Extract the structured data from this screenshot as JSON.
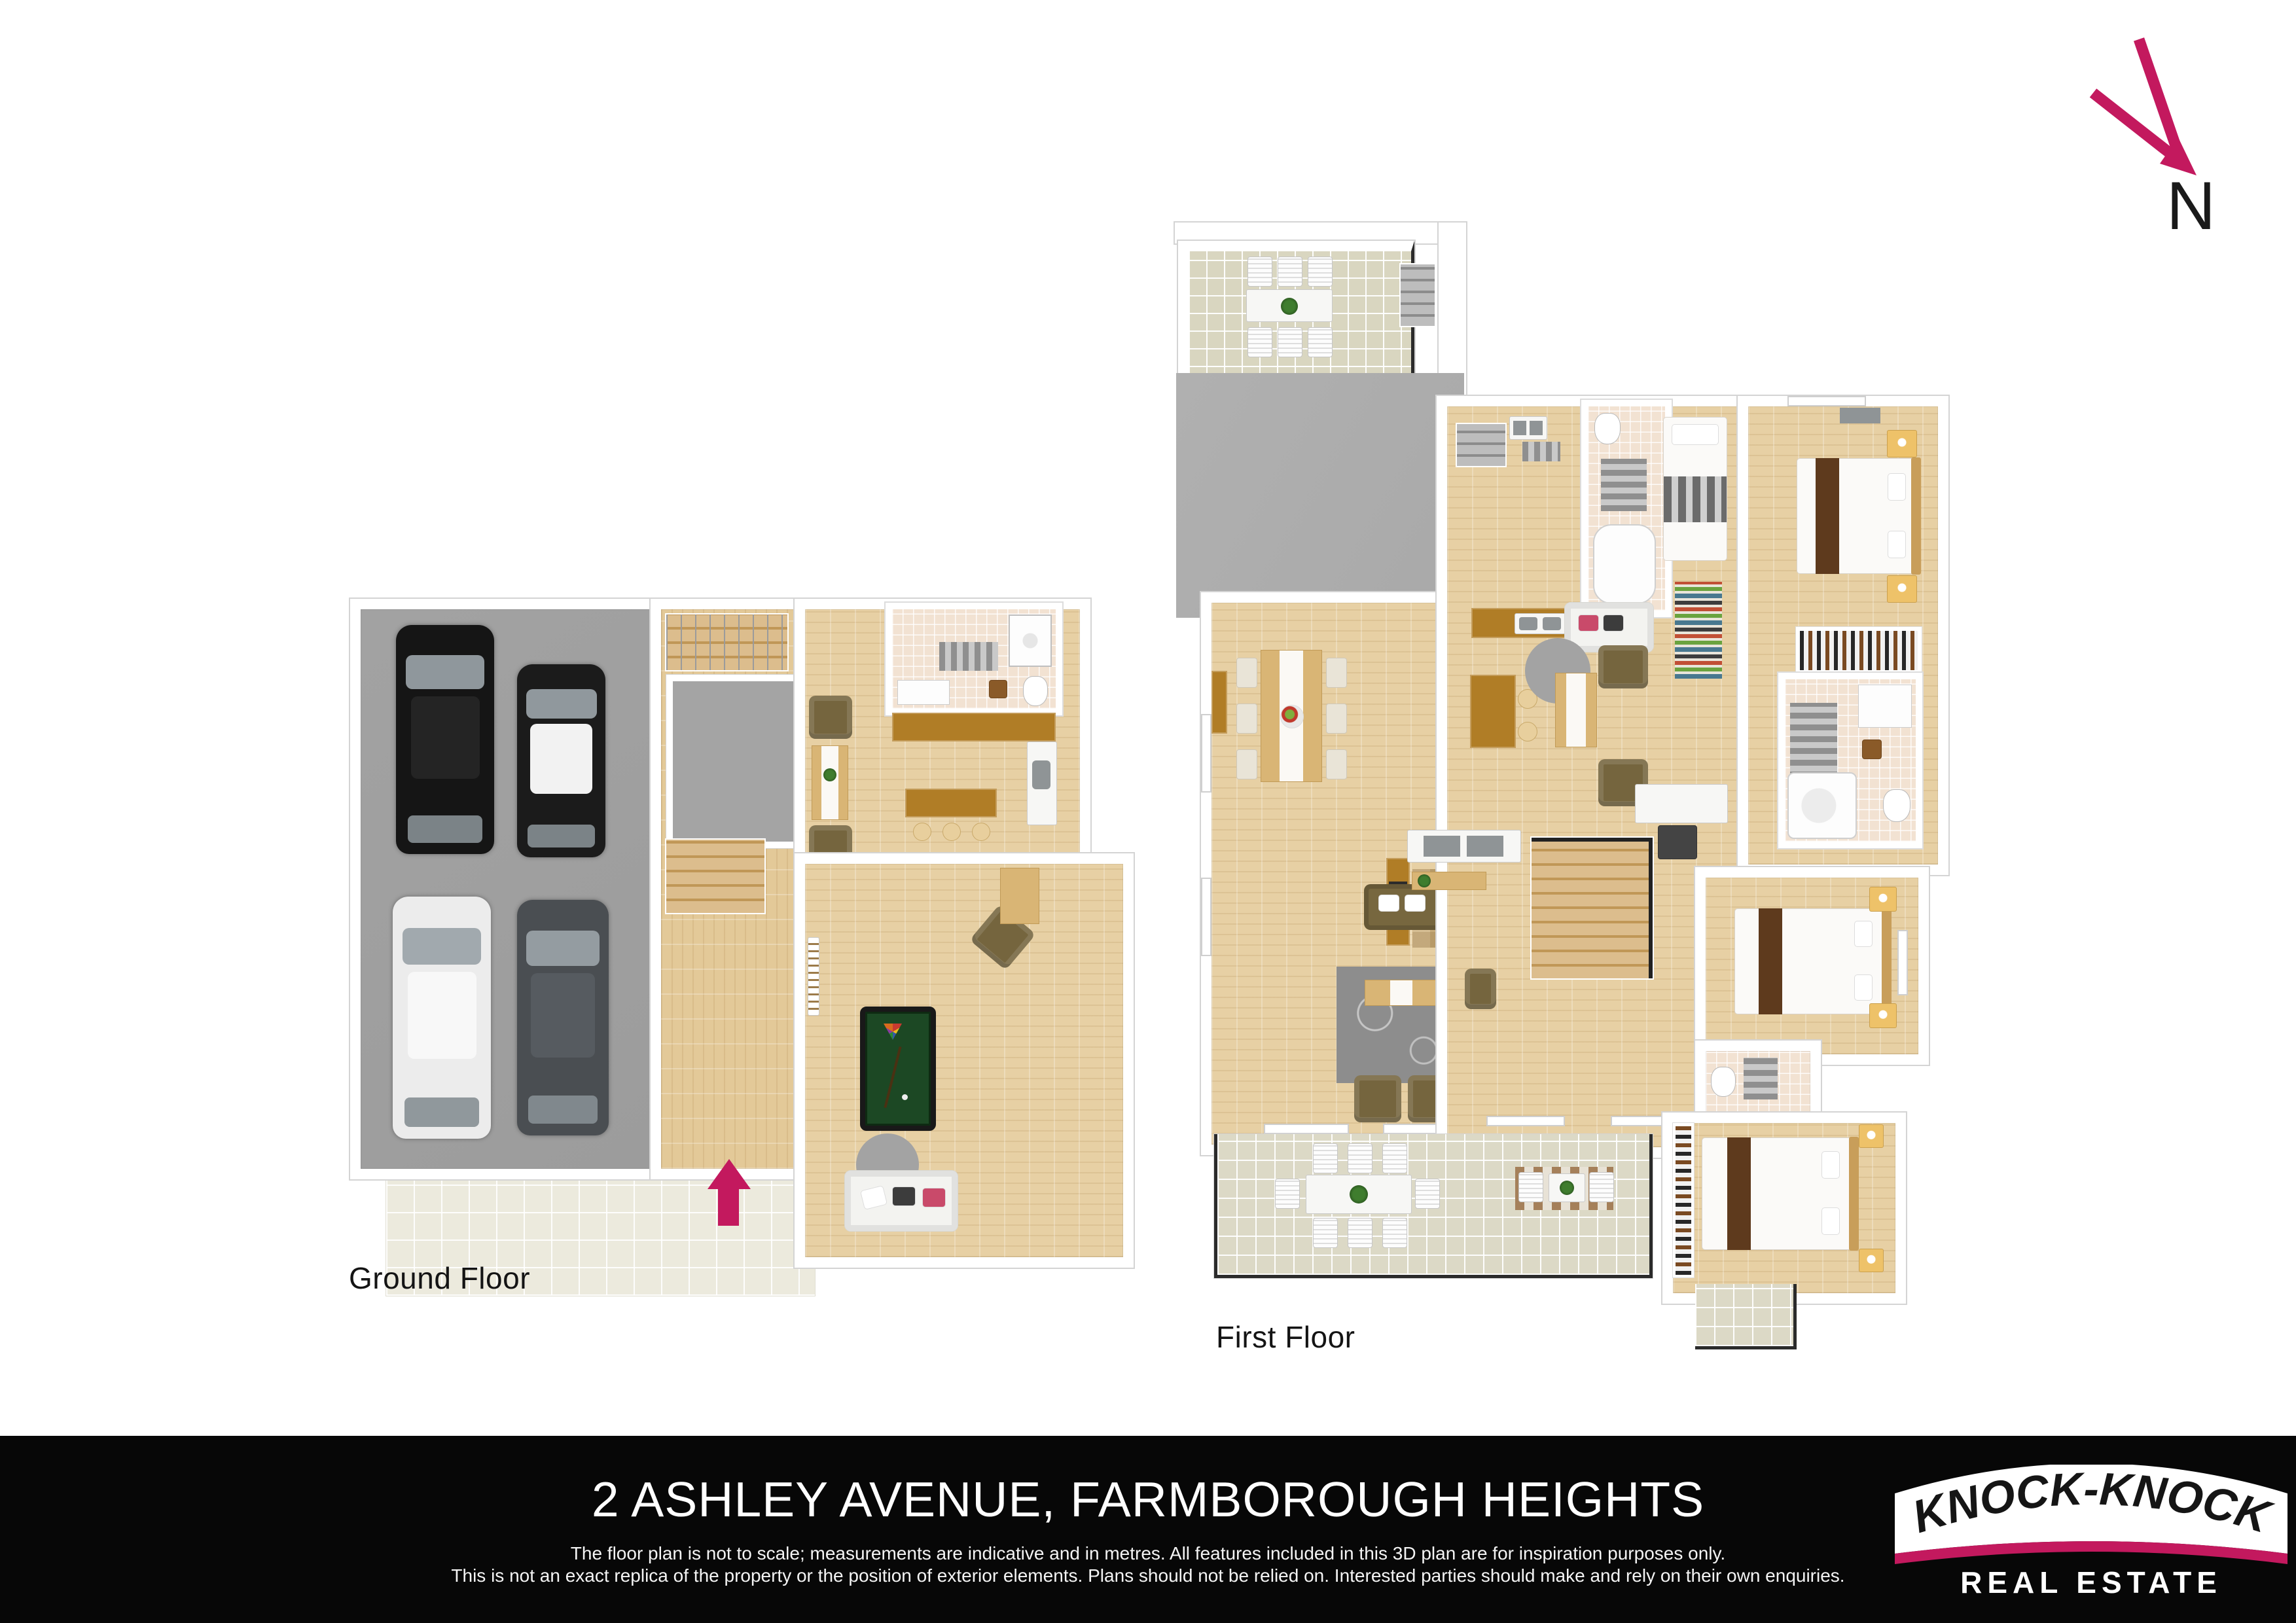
{
  "compass": {
    "label": "N"
  },
  "plans": {
    "ground": {
      "label": "Ground Floor"
    },
    "first": {
      "label": "First Floor"
    }
  },
  "footer": {
    "address": "2 ASHLEY AVENUE, FARMBOROUGH HEIGHTS",
    "disclaimer_line1": "The floor plan is not to scale; measurements are indicative and in metres. All features included in this 3D plan are for inspiration purposes only.",
    "disclaimer_line2": "This is not an exact replica of the property or the position of exterior elements. Plans should not be relied on. Interested parties should make and rely on their own enquiries."
  },
  "logo": {
    "name_arc": "“KNOCK-KNOCK”",
    "subtitle": "REAL ESTATE"
  },
  "palette": {
    "pagebg": "#ffffff",
    "accent": "#c3195e",
    "wall": "#ffffff",
    "walledge": "#d4d4d4",
    "wood": "#e7d0a4",
    "woodv": "#e3c998",
    "counter": "#b07d26",
    "tablewood": "#d9b575",
    "garage": "#9c9c9c",
    "roof": "#a9a9a9",
    "storage": "#a4a4a4",
    "terracetile": "#d9d6c0",
    "balctile": "#dcd9c6",
    "patiotile": "#eceadd",
    "bathtile": "#f2e2d2",
    "felt": "#1c4824",
    "ink": "#141414",
    "footerbg": "#070707"
  }
}
